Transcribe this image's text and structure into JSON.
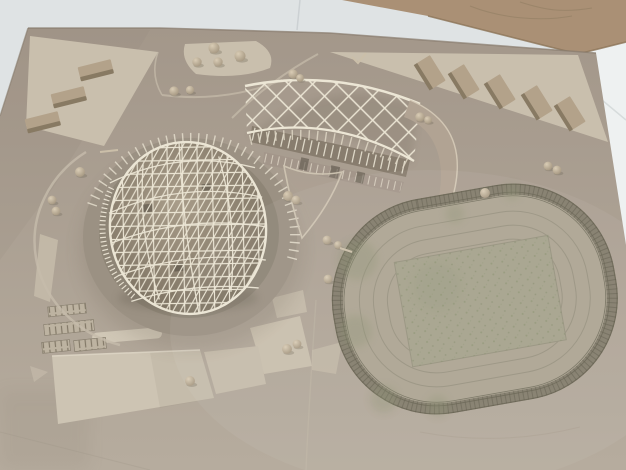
{
  "scene": {
    "type": "photograph",
    "subject": "Cardboard architectural scale model of a sports complex with a lattice-dome arena and an oval running-track stadium, photographed from above at an angle",
    "setting": "Grey-tan model board leaning against a white tiled wall; a second plain cardboard sheet stands behind the top-right corner",
    "objects": [
      {
        "name": "lattice-dome-arena",
        "description": "Egg-shaped gridshell dome of thin cream sticks set inside a sunken circular ring plaza with a rim colonnade"
      },
      {
        "name": "diagrid-canopy",
        "description": "Curved diamond-lattice canopy band over a linear building with vertical white fins"
      },
      {
        "name": "running-track-stadium",
        "description": "Oval athletics track ringed by a hatched grandstand band, mottled green infield in the centre"
      },
      {
        "name": "left-building-blocks",
        "description": "Three rectangular cardboard blocks on the pale triangular plot at top left"
      },
      {
        "name": "right-building-blocks",
        "description": "Five rectangular cardboard blocks in a row on the pale plot at top right"
      },
      {
        "name": "ball-trees",
        "description": "Small spherical model trees scattered over plazas, walkways and the stadium edge"
      },
      {
        "name": "parking-strips",
        "description": "Small hatched parking rectangles at lower left"
      },
      {
        "name": "light-plazas",
        "description": "Pale cut-out plates marking plazas, paths and a triangular central square"
      }
    ],
    "counts": {
      "left_blocks": 3,
      "right_blocks": 5,
      "trees": 24
    },
    "colors": {
      "wall": "#dfe3e4",
      "tiles": "#eef1f1",
      "sheet": "#aa9075",
      "board_top": "#a3978a",
      "board_bottom": "#b6ac9e",
      "plot": "#c9bfad",
      "plate": "#cdc4b3",
      "block_top": "#b3a28a",
      "block_side": "#887a63",
      "lattice": "#ebe5d4",
      "canopy_line": "#ece6d5",
      "dome_interior_hi": "#a89c89",
      "dome_interior_lo": "#766c5c",
      "ring": "#9b9183",
      "ring_inner": "#8e8576",
      "building_wall": "#887d6e",
      "track": "#ada593",
      "field": "#a6a38d",
      "stand": "#7d7866",
      "lane": "#8f8a78",
      "moss": "#8a9170",
      "tree_hi": "#d9ccb5",
      "tree_lo": "#a2947e"
    }
  }
}
